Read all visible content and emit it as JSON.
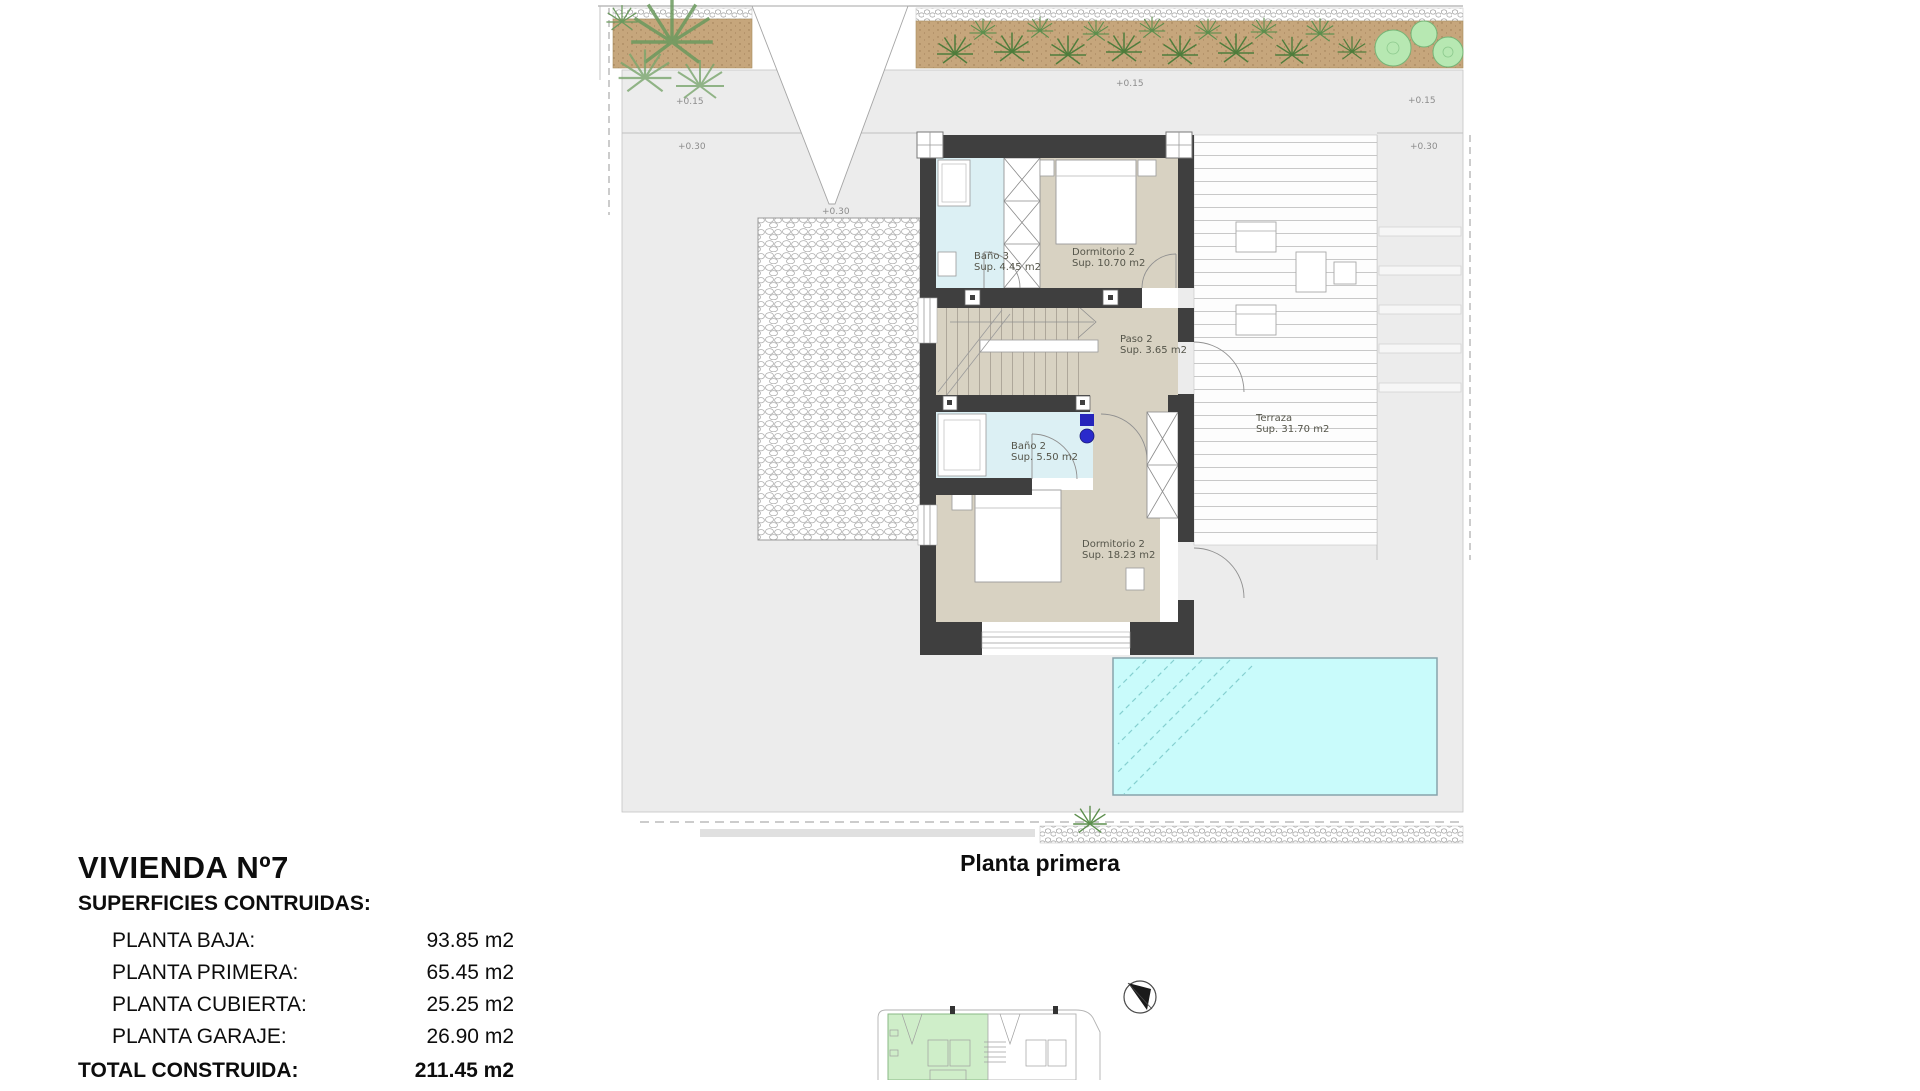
{
  "plan": {
    "caption": "Planta primera",
    "rooms": [
      {
        "name": "Baño 3",
        "area": "Sup. 4.45 m2"
      },
      {
        "name": "Dormitorio 2",
        "area": "Sup. 10.70 m2"
      },
      {
        "name": "Paso 2",
        "area": "Sup. 3.65 m2"
      },
      {
        "name": "Baño 2",
        "area": "Sup. 5.50 m2"
      },
      {
        "name": "Dormitorio 2",
        "area": "Sup. 18.23 m2"
      },
      {
        "name": "Terraza",
        "area": "Sup. 31.70 m2"
      }
    ],
    "levels": [
      {
        "id": "left-upper",
        "text": "+0.15"
      },
      {
        "id": "left-lower",
        "text": "+0.30"
      },
      {
        "id": "driveway-tip",
        "text": "+0.30"
      },
      {
        "id": "center-top",
        "text": "+0.15"
      },
      {
        "id": "right-upper",
        "text": "+0.15"
      },
      {
        "id": "right-lower",
        "text": "+0.30"
      }
    ]
  },
  "title_block": {
    "title": "VIVIENDA Nº7",
    "subtitle": "SUPERFICIES CONTRUIDAS:",
    "rows": [
      {
        "label": "PLANTA BAJA:",
        "value": "93.85 m2"
      },
      {
        "label": "PLANTA PRIMERA:",
        "value": "65.45 m2"
      },
      {
        "label": "PLANTA CUBIERTA:",
        "value": "25.25 m2"
      },
      {
        "label": "PLANTA GARAJE:",
        "value": "26.90 m2"
      }
    ],
    "total": {
      "label": "TOTAL CONSTRUIDA:",
      "value": "211.45 m2"
    }
  },
  "colors": {
    "wall": "#3f3f3f",
    "floor_tan": "#d8d2c2",
    "bath_blue": "#dcf0f4",
    "pool_water": "#c9fbfb",
    "soil": "#c6a67c",
    "foliage": "#4f7d3c",
    "tree": "#b7e8b2",
    "ground": "#ececec",
    "keyplan_highlight": "#cfeec9"
  }
}
